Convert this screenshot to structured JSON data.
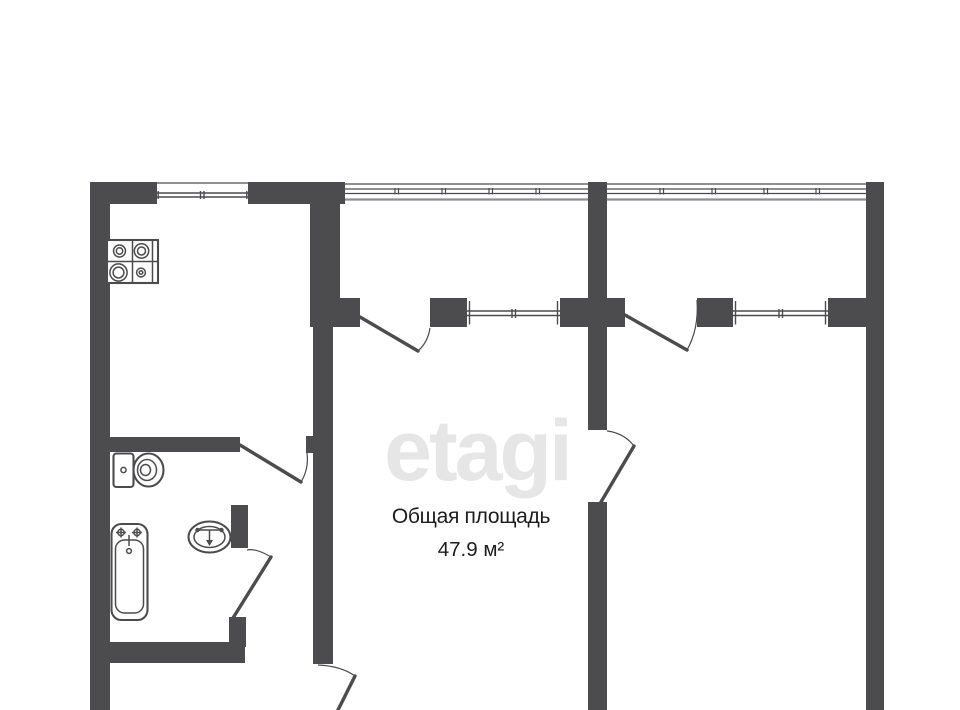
{
  "watermark": {
    "text": "etagi"
  },
  "area": {
    "label": "Общая площадь",
    "value": "47.9 м²"
  },
  "colors": {
    "wall": "#4c4c4e",
    "window_inner_edge": "#8e8e90",
    "watermark": "#e6e6e6",
    "text": "#1d1d1d",
    "background": "#ffffff"
  },
  "fixtures": [
    "stove-icon",
    "toilet-icon",
    "bathtub-icon",
    "sink-icon"
  ]
}
